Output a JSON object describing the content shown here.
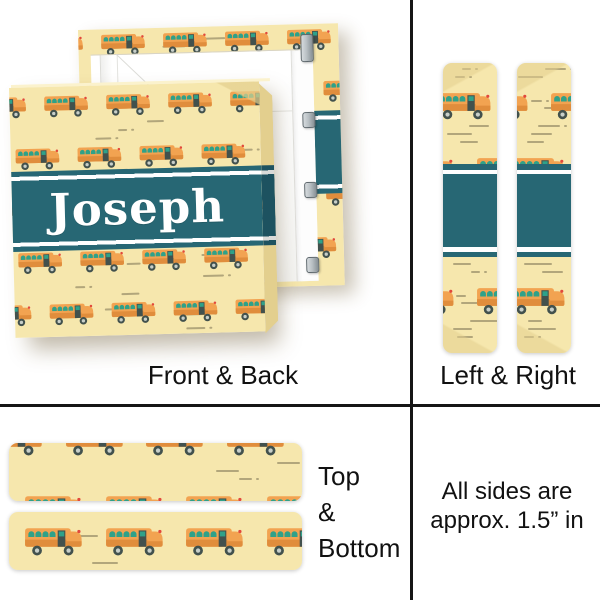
{
  "product": {
    "personalized_name": "Joseph"
  },
  "sections": {
    "front_back": {
      "label": "Front & Back"
    },
    "left_right": {
      "label": "Left & Right"
    },
    "top_bottom": {
      "lines": [
        "Top",
        "&",
        "Bottom"
      ]
    },
    "size_note": {
      "lines": [
        "All sides are",
        "approx. 1.5” in"
      ]
    }
  },
  "icons": {
    "bus": "school-bus-icon",
    "dash": "speed-dash-decoration"
  },
  "colors": {
    "pattern_bg": "#F6E7AD",
    "pattern_bg_shade": "#E3CF8E",
    "bus_body": "#F2A351",
    "bus_body_dark": "#E08D3C",
    "bus_window": "#2FA189",
    "bus_detail": "#42514D",
    "wheel_hub": "#C8CFC9",
    "bus_red": "#E2493C",
    "dash": "#6E6549",
    "band": "#276774",
    "band_dark": "#1D5260",
    "stripe_white": "#FFFFFF",
    "metal": "#B9C0C4",
    "divider": "#151515",
    "label_ink": "#111111",
    "name_ink": "#FFFFFF"
  }
}
